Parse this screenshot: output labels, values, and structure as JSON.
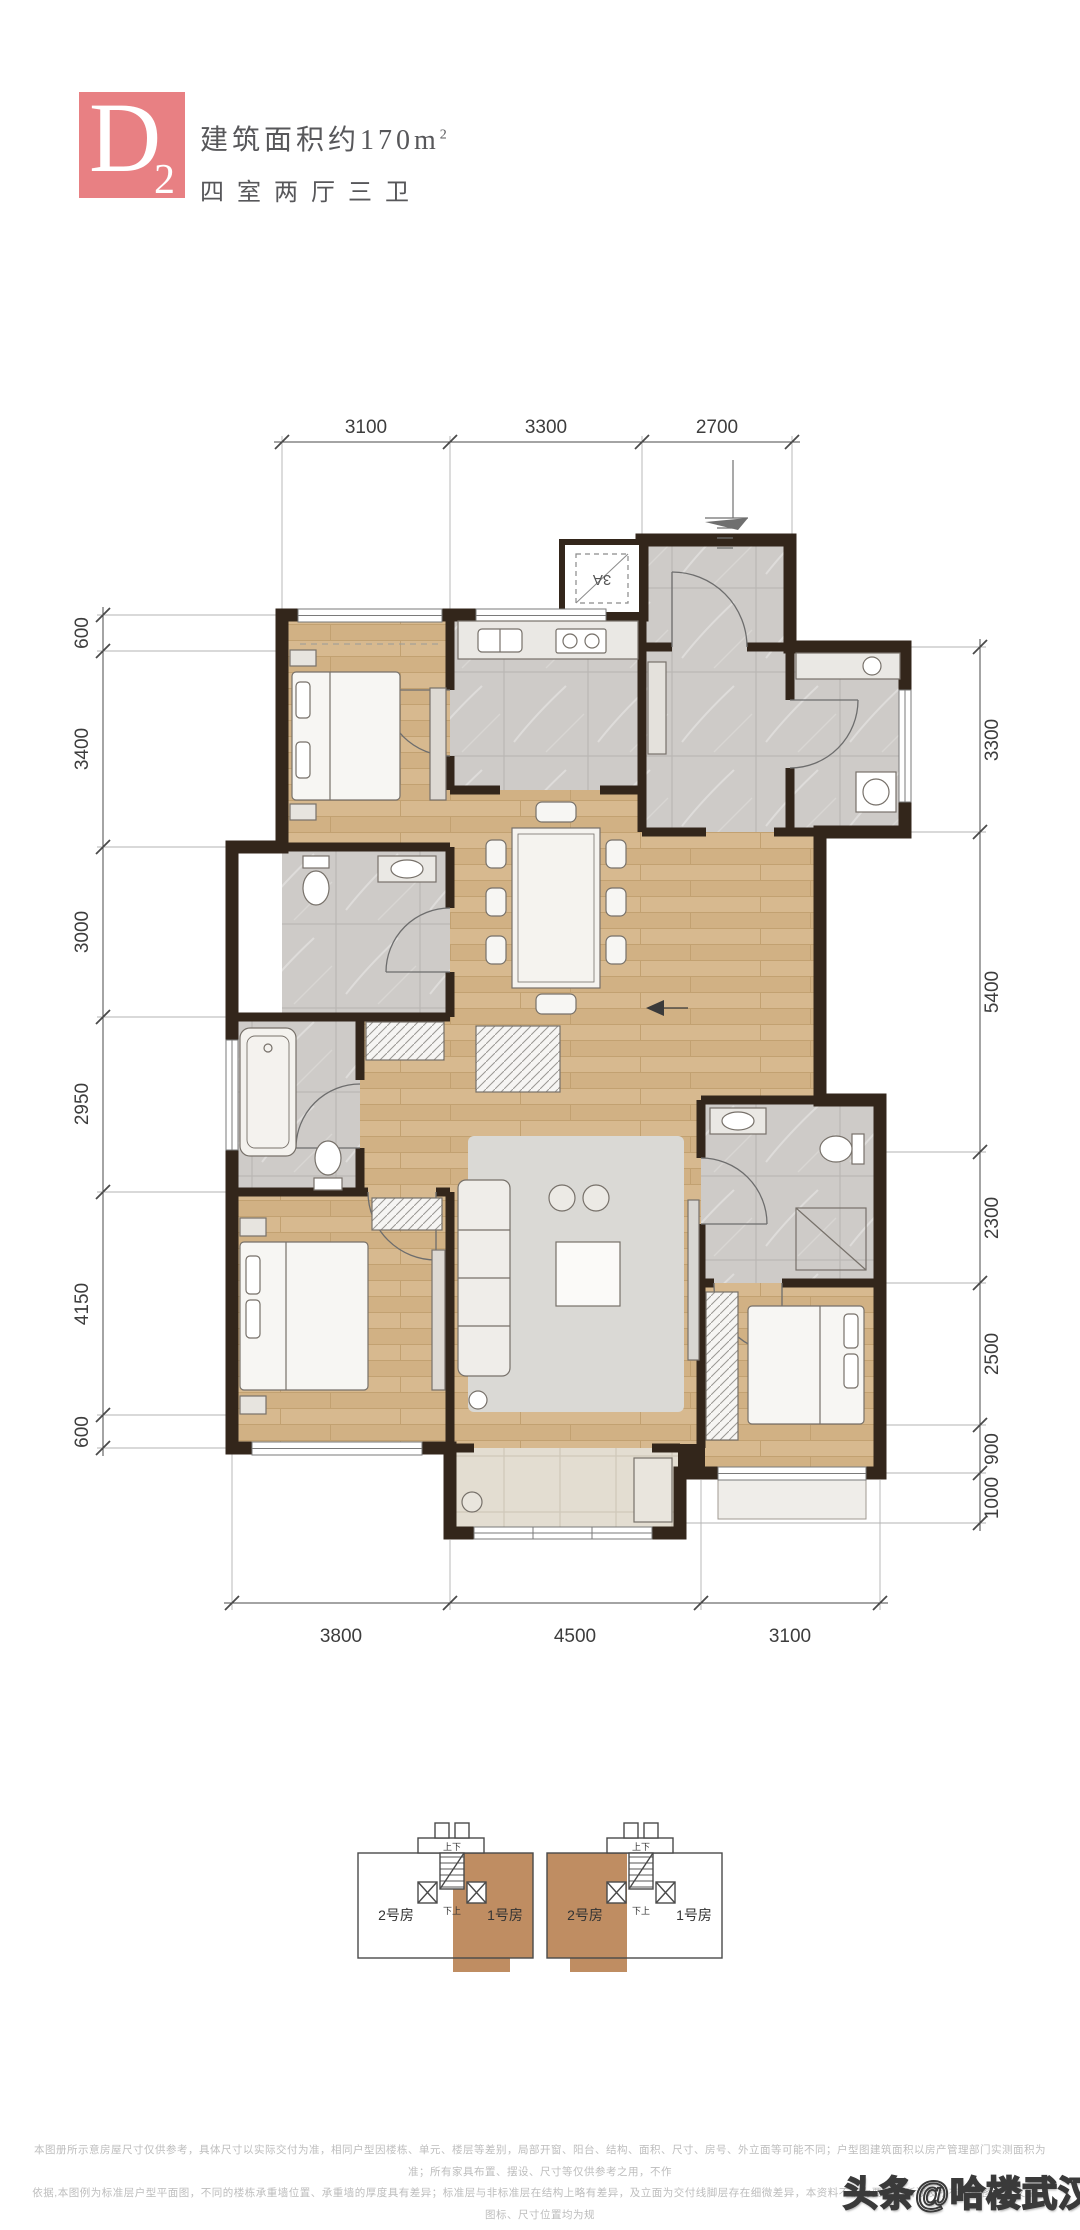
{
  "header": {
    "badge_letter": "D",
    "badge_sub": "2",
    "area_text": "建筑面积约170m",
    "area_sup": "2",
    "layout_text": "四室两厅三卫"
  },
  "plan": {
    "flue_label": "3A",
    "dims": {
      "top": [
        "3100",
        "3300",
        "2700"
      ],
      "bottom": [
        "3800",
        "4500",
        "3100"
      ],
      "left": [
        "600",
        "3400",
        "3000",
        "2950",
        "4150",
        "600"
      ],
      "right": [
        "3300",
        "5400",
        "2300",
        "2500",
        "900",
        "1000"
      ]
    }
  },
  "keyplan": {
    "units": [
      "2号房",
      "1号房",
      "2号房",
      "1号房"
    ],
    "stair_top": "上下",
    "stair_bottom": "下上"
  },
  "disclaimer": {
    "line1": "本图册所示意房屋尺寸仅供参考，具体尺寸以实际交付为准，相同户型因楼栋、单元、楼层等差别，局部开窗、阳台、结构、面积、尺寸、房号、外立面等可能不同；户型图建筑面积以房产管理部门实测面积为准；所有家具布置、摆设、尺寸等仅供参考之用，不作",
    "line2": "依据,本图例为标准层户型平面图，不同的楼栋承重墙位置、承重墙的厚度具有差异；标准层与非标准层在结构上略有差异，及立面为交付线脚层存在细微差异，本资料不视为要约；所涉及所有相关图片、文字、图标、尺寸位置均为规",
    "line3": "划设计成果，仅供参考，具体以竣工备案的资料和双方的合同约定为准，本户型图所标的尺寸仅供参考，交房尺寸以合同约定为准。"
  },
  "watermark": {
    "text": "头条@哈楼武汉"
  },
  "colors": {
    "badge": "#e88083",
    "wall": "#33261b",
    "wood_floor": "#d7b98f",
    "tile_floor": "#cecbc8",
    "keyplan_highlight": "#bf8d62",
    "dim_text": "#3d3d3d",
    "disclaimer_text": "#bdbdbd"
  }
}
